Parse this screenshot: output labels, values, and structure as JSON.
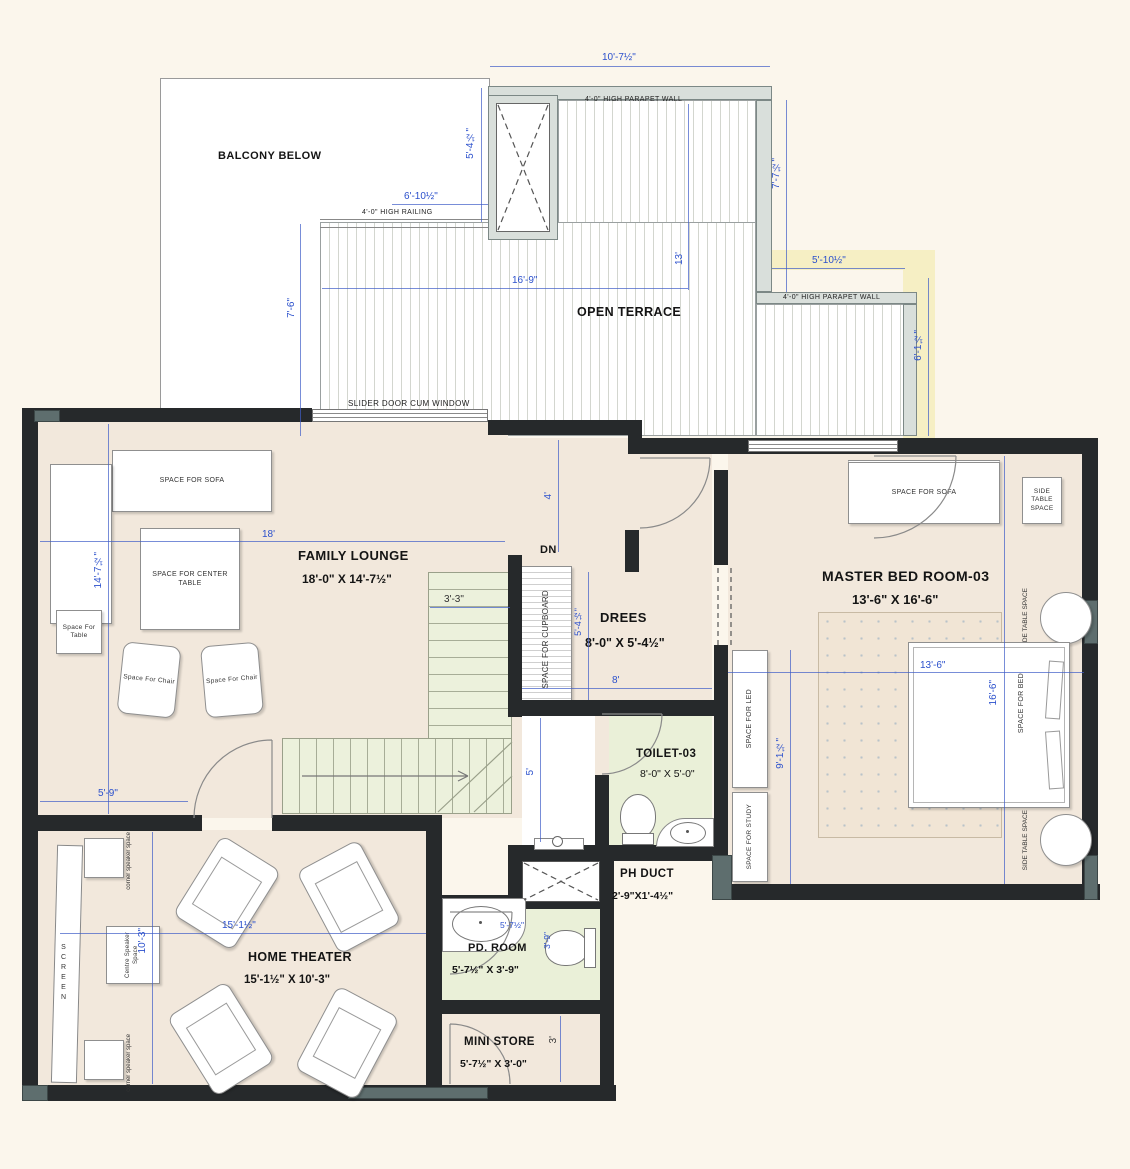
{
  "colors": {
    "dim_blue": "#2b50cc",
    "wall_dark": "#26292b",
    "floor_beige": "#f2e8dc",
    "room_green": "#eaf0d8",
    "parapet_gray": "#d9dfdb",
    "bg_cream": "#fbf6ec",
    "highlight_yellow": "#f6efc4"
  },
  "terrace": {
    "balcony_label": "BALCONY BELOW",
    "name": "OPEN TERRACE",
    "parapet_note_top": "4'-0\" HIGH PARAPET WALL",
    "parapet_note_right": "4'-0\" HIGH PARAPET WALL",
    "railing_note": "4'-0\" HIGH RAILING",
    "slider_label": "SLIDER DOOR CUM WINDOW",
    "dim_width_top": "10'-7½\"",
    "dim_left_upper": "5'-4½\"",
    "dim_right_upper": "7'-7½\"",
    "dim_railing": "6'-10½\"",
    "dim_mid_height": "13'",
    "dim_mid_width": "16'-9\"",
    "dim_left_lower": "7'-6\"",
    "dim_right_width": "5'-10½\"",
    "dim_right_lower": "6'-1½\""
  },
  "family_lounge": {
    "name": "FAMILY LOUNGE",
    "size": "18'-0\" X 14'-7½\"",
    "dim_width": "18'",
    "dim_height": "14'-7½\"",
    "dim_door": "5'-9\"",
    "dim_hall": "4'",
    "sofa": "SPACE  FOR SOFA",
    "center_table": "SPACE  FOR CENTER TABLE",
    "side_table": "Space For Table",
    "chair": "Space For Chair"
  },
  "stairs": {
    "dn": "DN",
    "dim_width": "3'-3\"",
    "cupboard": "SPACE FOR CUPBOARD"
  },
  "drees": {
    "name": "DREES",
    "size": "8'-0\" X 5'-4½\"",
    "dim_width": "8'",
    "dim_height": "5'-4½\""
  },
  "master_bedroom": {
    "name": "MASTER BED ROOM-03",
    "size": "13'-6\" X 16'-6\"",
    "dim_width": "13'-6\"",
    "dim_height": "16'-6\"",
    "dim_inner": "9'-1½\"",
    "sofa": "SPACE FOR SOFA",
    "side_table": "SIDE TABLE SPACE",
    "bed": "SPACE FOR BED",
    "led": "SPACE FOR LED",
    "study": "SPACE FOR STUDY"
  },
  "toilet": {
    "name": "TOILET-03",
    "size": "8'-0\" X 5'-0\"",
    "dim_height": "5'"
  },
  "ph_duct": {
    "name": "PH DUCT",
    "size": "2'-9\"X1'-4½\""
  },
  "pd_room": {
    "name": "PD. ROOM",
    "size": "5'-7½\" X 3'-9\"",
    "dim_width": "5'-7½\"",
    "dim_height": "3'-9\""
  },
  "mini_store": {
    "name": "MINI STORE",
    "size": "5'-7½\" X 3'-0\"",
    "dim_height": "3'"
  },
  "home_theater": {
    "name": "HOME THEATER",
    "size": "15'-1½\" X 10'-3\"",
    "dim_width": "15'-1½\"",
    "dim_height": "10'-3\"",
    "screen": "SCREEN",
    "corner_speaker": "corner speaker space",
    "centre_speaker": "Centre Speaker Space"
  }
}
